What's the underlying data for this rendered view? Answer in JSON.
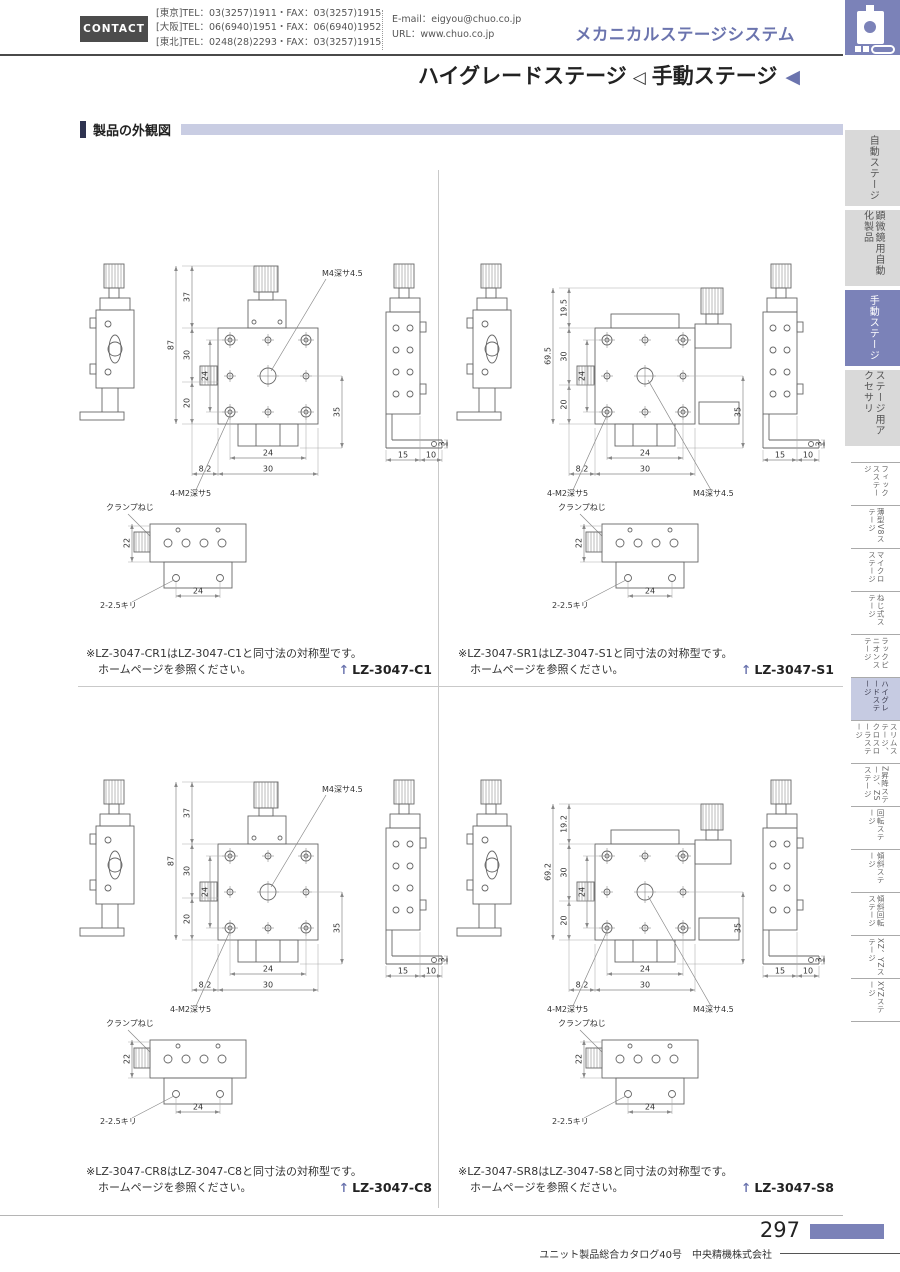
{
  "header": {
    "contact_label": "CONTACT",
    "phone_lines": [
      "[東京]TEL：03(3257)1911・FAX：03(3257)1915",
      "[大阪]TEL：06(6940)1951・FAX：06(6940)1952",
      "[東北]TEL：0248(28)2293・FAX：03(3257)1915"
    ],
    "email": "E-mail：eigyou@chuo.co.jp",
    "url": "URL：www.chuo.co.jp",
    "system_title": "メカニカルステージシステム",
    "page_title_left": "ハイグレードステージ",
    "page_title_right": "手動ステージ"
  },
  "icons": {
    "tri_outline": "◁",
    "tri_solid": "◀",
    "model_arrow": "↑",
    "logo_name": "stage-logo"
  },
  "section": {
    "title": "製品の外観図"
  },
  "sidebar": {
    "tabs": [
      {
        "label": "自動ステージ",
        "active": false
      },
      {
        "label": "顕微鏡用自動化製品",
        "active": false
      },
      {
        "label": "手動ステージ",
        "active": true
      },
      {
        "label": "ステージ用アクセサリ",
        "active": false
      }
    ],
    "index_items": [
      {
        "label": "フィックスステージ",
        "active": false
      },
      {
        "label": "薄型V8ステージ",
        "active": false
      },
      {
        "label": "マイクロステージ",
        "active": false
      },
      {
        "label": "ねじ式ステージ",
        "active": false
      },
      {
        "label": "ラックピニオンステージ",
        "active": false
      },
      {
        "label": "ハイグレードステージ",
        "active": true
      },
      {
        "label": "スリムステージ、クロスローラステージ",
        "active": false
      },
      {
        "label": "Z昇降ステージ、ZSステージ",
        "active": false
      },
      {
        "label": "回転ステージ",
        "active": false
      },
      {
        "label": "傾斜ステージ",
        "active": false
      },
      {
        "label": "傾斜回転ステージ",
        "active": false
      },
      {
        "label": "XZ、YZステージ",
        "active": false
      },
      {
        "label": "XYZステージ",
        "active": false
      }
    ]
  },
  "quadrants": [
    {
      "model": "LZ-3047-C1",
      "note_line1": "※LZ-3047-CR1はLZ-3047-C1と同寸法の対称型です。",
      "note_line2": "ホームページを参照ください。",
      "variant": "top",
      "dims": {
        "total": "87",
        "seg1": "37",
        "seg2": "30",
        "seg3": "20",
        "inner": "24",
        "right": "35",
        "foot": "3",
        "b1": "24",
        "b2": "30",
        "b3": "8.2",
        "s1": "15",
        "s2": "10",
        "center_hole": "M4深サ4.5",
        "corner_hole": "4-M2深サ5",
        "clamp": "クランプねじ",
        "clamp_h": "22",
        "clamp_drill": "2-2.5キリ",
        "clamp_w": "24"
      }
    },
    {
      "model": "LZ-3047-S1",
      "note_line1": "※LZ-3047-SR1はLZ-3047-S1と同寸法の対称型です。",
      "note_line2": "ホームページを参照ください。",
      "variant": "side",
      "dims": {
        "total": "69.5",
        "seg1": "19.5",
        "seg2": "30",
        "seg3": "20",
        "inner": "24",
        "right": "35",
        "foot": "3",
        "b1": "24",
        "b2": "30",
        "b3": "8.2",
        "s1": "15",
        "s2": "10",
        "center_hole": "M4深サ4.5",
        "corner_hole": "4-M2深サ5",
        "clamp": "クランプねじ",
        "clamp_h": "22",
        "clamp_drill": "2-2.5キリ",
        "clamp_w": "24"
      }
    },
    {
      "model": "LZ-3047-C8",
      "note_line1": "※LZ-3047-CR8はLZ-3047-C8と同寸法の対称型です。",
      "note_line2": "ホームページを参照ください。",
      "variant": "top",
      "dims": {
        "total": "87",
        "seg1": "37",
        "seg2": "30",
        "seg3": "20",
        "inner": "24",
        "right": "35",
        "foot": "3",
        "b1": "24",
        "b2": "30",
        "b3": "8.2",
        "s1": "15",
        "s2": "10",
        "center_hole": "M4深サ4.5",
        "corner_hole": "4-M2深サ5",
        "clamp": "クランプねじ",
        "clamp_h": "22",
        "clamp_drill": "2-2.5キリ",
        "clamp_w": "24"
      }
    },
    {
      "model": "LZ-3047-S8",
      "note_line1": "※LZ-3047-SR8はLZ-3047-S8と同寸法の対称型です。",
      "note_line2": "ホームページを参照ください。",
      "variant": "side",
      "dims": {
        "total": "69.2",
        "seg1": "19.2",
        "seg2": "30",
        "seg3": "20",
        "inner": "24",
        "right": "35",
        "foot": "3",
        "b1": "24",
        "b2": "30",
        "b3": "8.2",
        "s1": "15",
        "s2": "10",
        "center_hole": "M4深サ4.5",
        "corner_hole": "4-M2深サ5",
        "clamp": "クランプねじ",
        "clamp_h": "22",
        "clamp_drill": "2-2.5キリ",
        "clamp_w": "24"
      }
    }
  ],
  "footer": {
    "page_number": "297",
    "catalog_info": "ユニット製品総合カタログ40号　中央精機株式会社"
  },
  "colors": {
    "accent": "#7b82b8",
    "accent_text": "#6b74ae",
    "section_band": "#c9cde3",
    "tab_bg": "#d9d9d9",
    "active_index_bg": "#c6cbe2"
  }
}
